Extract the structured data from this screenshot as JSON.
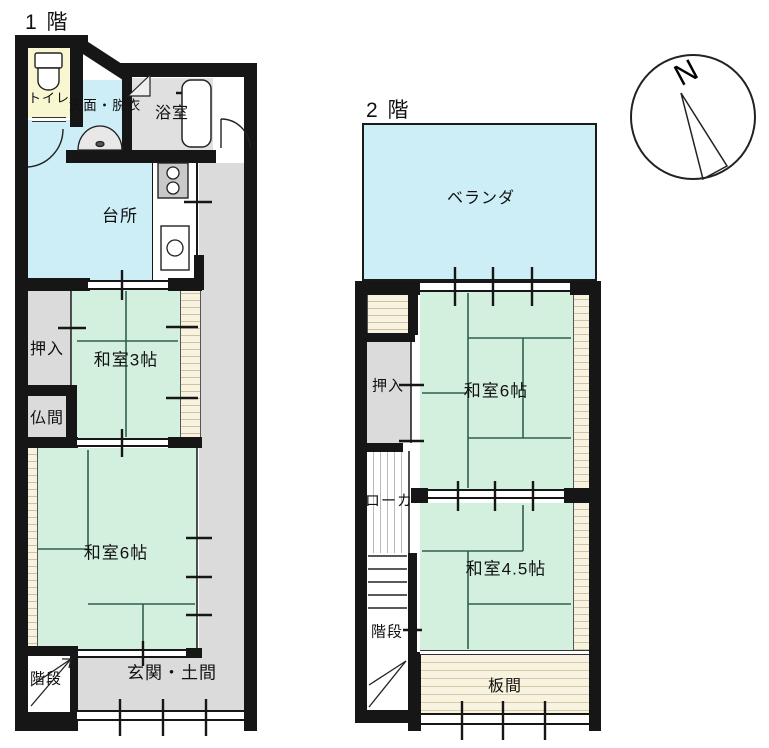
{
  "floor1": {
    "title": "1 階",
    "rooms": {
      "toilet": "トイレ",
      "washroom": "洗面・脱衣",
      "bath": "浴室",
      "kitchen": "台所",
      "closet": "押入",
      "tatami3": "和室3帖",
      "butsuma": "仏間",
      "tatami6": "和室6帖",
      "stairs": "階段",
      "entrance": "玄関・土間"
    }
  },
  "floor2": {
    "title": "2 階",
    "rooms": {
      "veranda": "ベランダ",
      "closet": "押入",
      "tatami6": "和室6帖",
      "hallway": "ローカ",
      "tatami45": "和室4.5帖",
      "stairs": "階段",
      "itanoma": "板間"
    }
  },
  "compass": {
    "label": "N"
  },
  "colors": {
    "wall": "#161616",
    "water_blue": "#cdeef7",
    "tatami_green": "#d3f0df",
    "tatami_line": "#2f5f50",
    "room_gray": "#dbdbdb",
    "toilet_cream": "#f9f6d2",
    "wood_cream": "#f8f2e0",
    "hatch_line": "#cfc2a0"
  }
}
